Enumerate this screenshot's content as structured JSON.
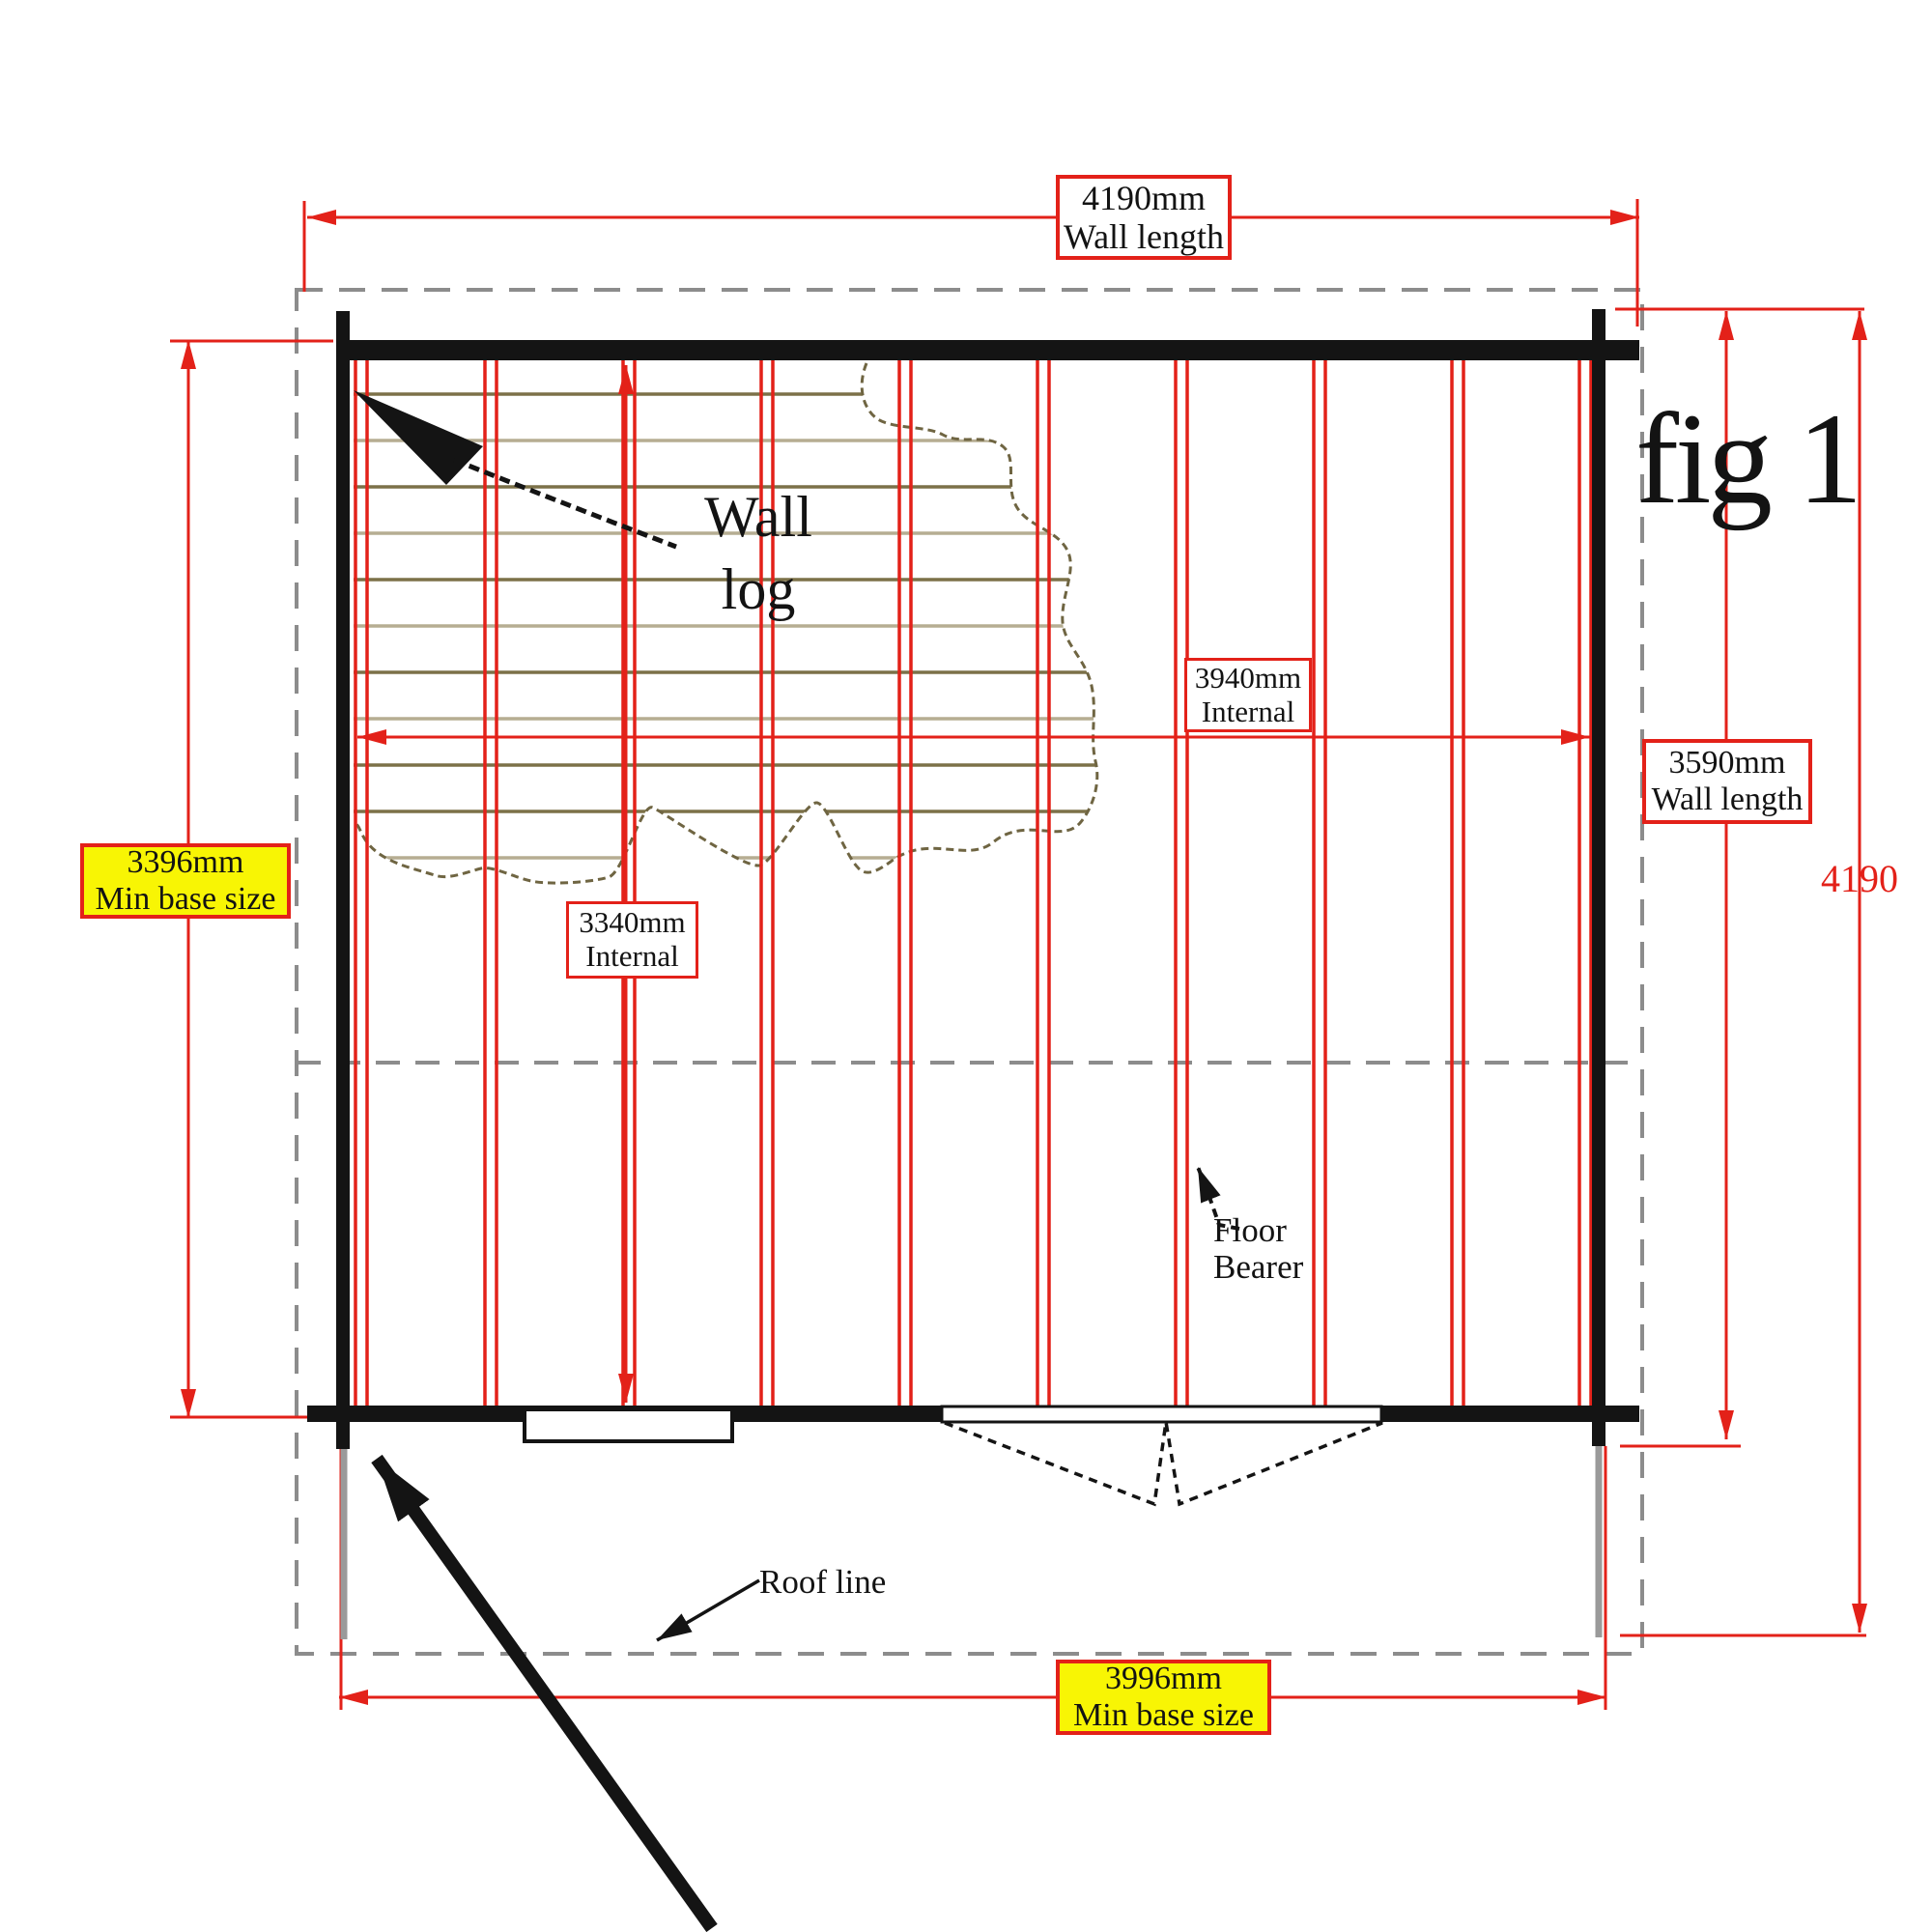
{
  "figure": {
    "label": "fig 1"
  },
  "dimensions": {
    "top_wall": {
      "value": "4190mm",
      "label": "Wall length"
    },
    "right_wall": {
      "value": "3590mm",
      "label": "Wall length"
    },
    "overall_depth": {
      "value": "4190"
    },
    "left_min_base": {
      "value": "3396mm",
      "label": "Min base size"
    },
    "bottom_min_base": {
      "value": "3996mm",
      "label": "Min base size"
    },
    "internal_width": {
      "value": "3940mm",
      "label": "Internal"
    },
    "internal_depth": {
      "value": "3340mm",
      "label": "Internal"
    }
  },
  "annotations": {
    "wall_log": {
      "line1": "Wall",
      "line2": "log"
    },
    "floor_bearer": {
      "line1": "Floor",
      "line2": "Bearer"
    },
    "roof_line": {
      "label": "Roof line"
    }
  },
  "colors": {
    "dimension_red": "#e32119",
    "highlight_yellow": "#f8f504",
    "log_line_dark": "#7c7148",
    "log_line_light": "#b6ad92",
    "wall_black": "#141414",
    "roof_dash_gray": "#8c8c8c"
  }
}
